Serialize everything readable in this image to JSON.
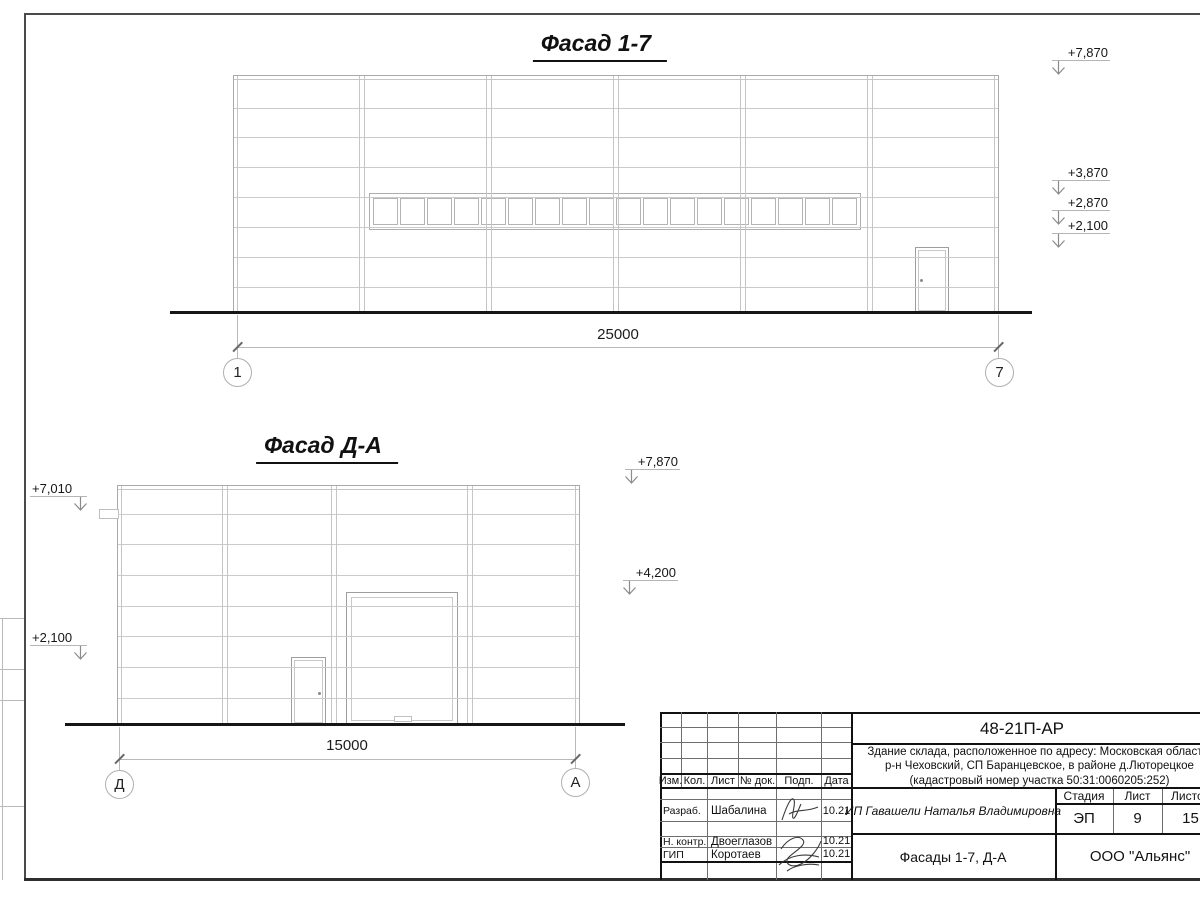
{
  "facade17": {
    "title": "Фасад 1-7",
    "dim": "25000",
    "axis_left": "1",
    "axis_right": "7",
    "levels": {
      "l1": "+7,870",
      "l2": "+3,870",
      "l3": "+2,870",
      "l4": "+2,100"
    }
  },
  "facadeDA": {
    "title": "Фасад Д-А",
    "dim": "15000",
    "axis_left": "Д",
    "axis_right": "А",
    "levels": {
      "left1": "+7,010",
      "left2": "+2,100",
      "right1": "+7,870",
      "right2": "+4,200"
    }
  },
  "titleblock": {
    "doc_number": "48-21П-АР",
    "project_line1": "Здание склада, расположенное по адресу: Московская область,",
    "project_line2": "р-н Чеховский, СП Баранцевское, в районе д.Люторецкое",
    "project_line3": "(кадастровый номер участка 50:31:0060205:252)",
    "cols": {
      "izm": "Изм.",
      "kol": "Кол.",
      "list": "Лист",
      "doc": "№ док.",
      "podp": "Подп.",
      "date": "Дата"
    },
    "rows": [
      {
        "role": "Разраб.",
        "name": "Шабалина",
        "date": "10.21"
      },
      {
        "role": "Н. контр.",
        "name": "Двоеглазов",
        "date": "10.21"
      },
      {
        "role": "ГИП",
        "name": "Коротаев",
        "date": "10.21"
      }
    ],
    "client": "ИП Гавашели Наталья Владимировна",
    "stage_label": "Стадия",
    "sheet_label": "Лист",
    "sheets_label": "Листов",
    "stage": "ЭП",
    "sheet_no": "9",
    "sheets_total": "15",
    "sheet_title": "Фасады 1-7, Д-А",
    "org": "ООО \"Альянс\""
  }
}
